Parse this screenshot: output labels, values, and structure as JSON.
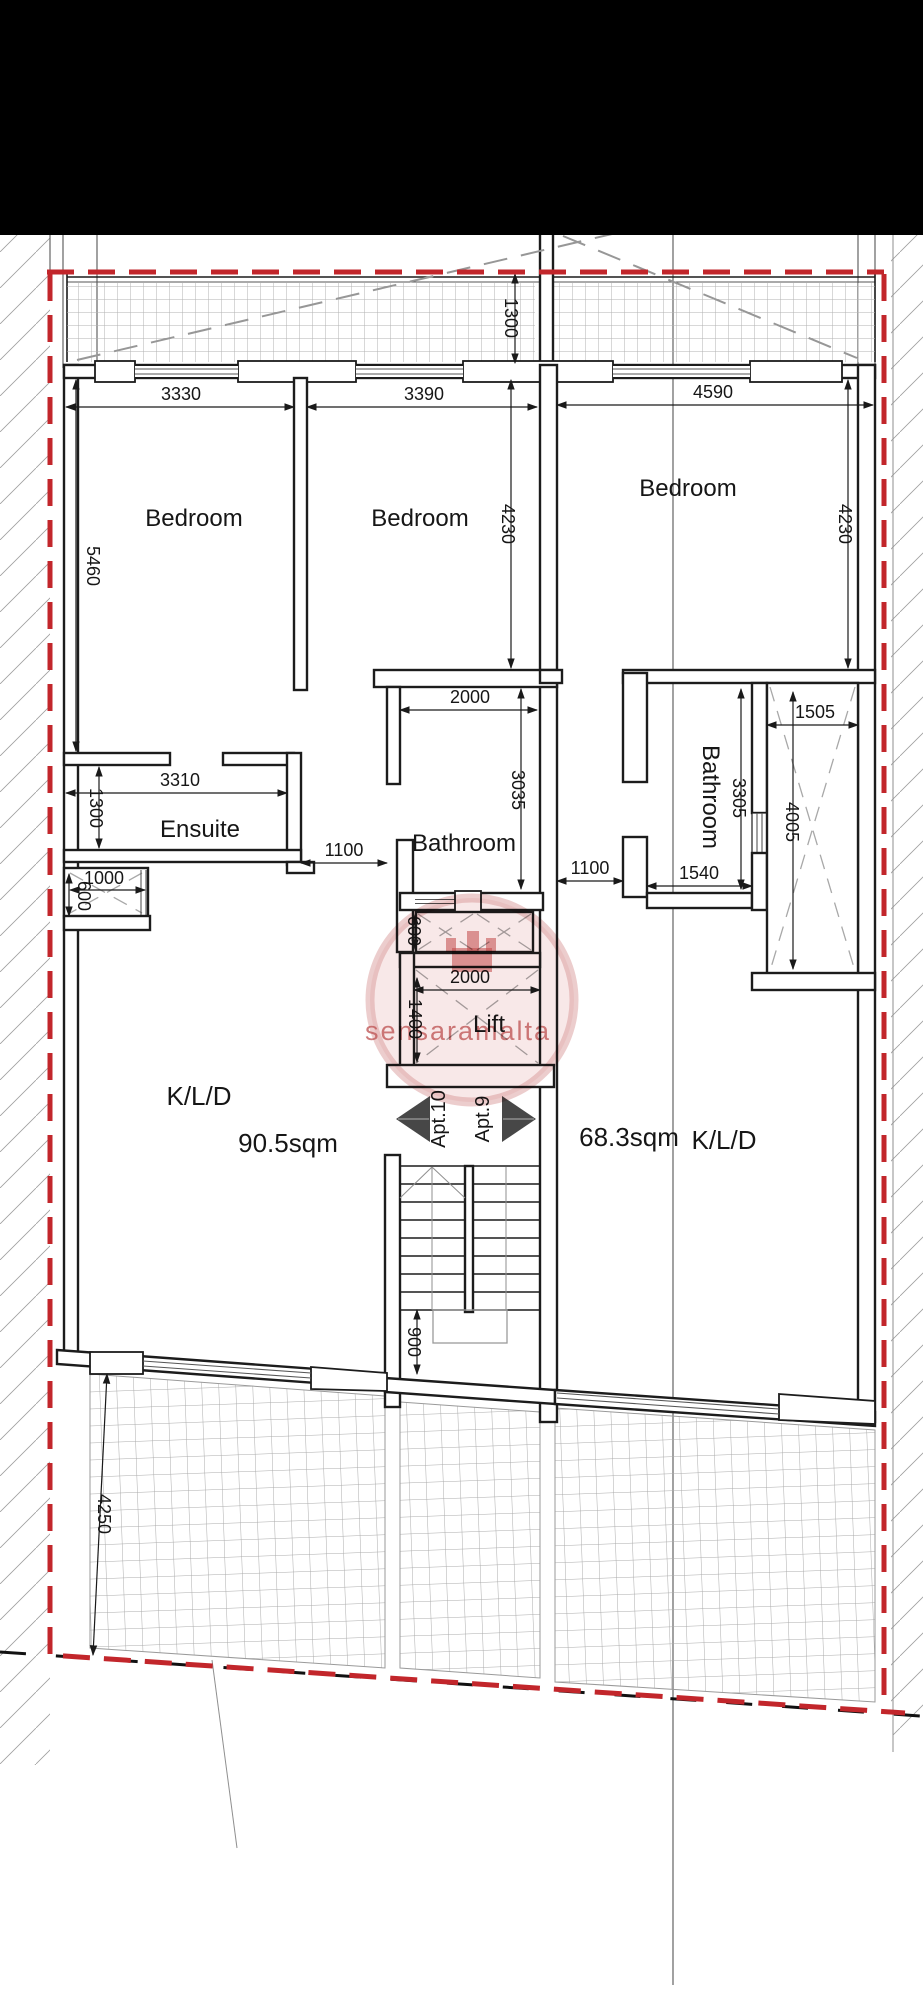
{
  "plan": {
    "rooms": [
      {
        "id": "bedroom-1",
        "label": "Bedroom"
      },
      {
        "id": "bedroom-2",
        "label": "Bedroom"
      },
      {
        "id": "bedroom-3",
        "label": "Bedroom"
      },
      {
        "id": "ensuite",
        "label": "Ensuite"
      },
      {
        "id": "bathroom-left",
        "label": "Bathroom"
      },
      {
        "id": "bathroom-right",
        "label": "Bathroom"
      },
      {
        "id": "lift",
        "label": "Lift"
      },
      {
        "id": "kld-left",
        "label": "K/L/D"
      },
      {
        "id": "kld-right",
        "label": "K/L/D"
      }
    ],
    "apartments": [
      {
        "name": "Apt.10",
        "area": "90.5sqm"
      },
      {
        "name": "Apt.9",
        "area": "68.3sqm"
      }
    ],
    "dimensions": [
      "3330",
      "3390",
      "4590",
      "1300",
      "5460",
      "4230",
      "4230",
      "2000",
      "3035",
      "3310",
      "1300",
      "1100",
      "1000",
      "600",
      "1100",
      "1540",
      "1505",
      "3305",
      "4005",
      "600",
      "2000",
      "1400",
      "900",
      "4250"
    ],
    "watermark": {
      "text": "sensaramalta"
    },
    "colors": {
      "boundary_red": "#c2262b",
      "wall_black": "#1c1c1c",
      "watermark_pink": "#c05858"
    }
  }
}
